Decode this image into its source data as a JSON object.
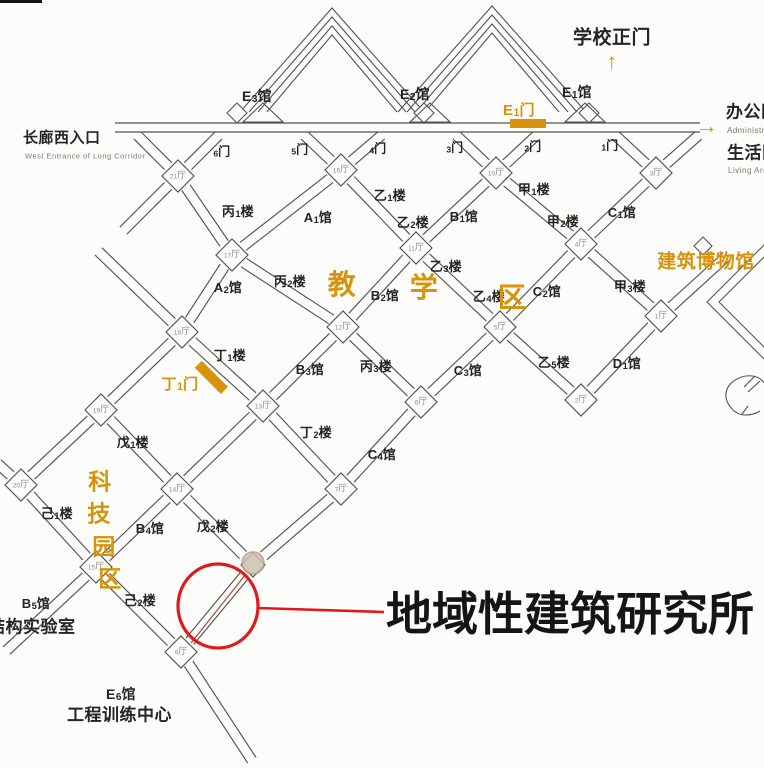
{
  "title": "campus-map-with-callout",
  "annotation": {
    "callout_text": "地域性建筑研究所",
    "callout_x": 386,
    "callout_y": 614,
    "callout_size": 46,
    "circle": {
      "cx": 218,
      "cy": 606,
      "rx": 40,
      "ry": 42
    },
    "line": {
      "x1": 257,
      "y1": 608,
      "x2": 384,
      "y2": 612
    }
  },
  "colors": {
    "accent": "#d7930c",
    "red": "#e2191b",
    "line": "#56524d",
    "hall_text": "#8f8c84",
    "text": "#242420",
    "sub": "#7d7a72",
    "marker_fill": "#cfc0b2",
    "marker_stroke": "#ab9a86",
    "highlight": "#a85440",
    "edge_artifact": "#141414"
  },
  "map": {
    "nodes": [
      {
        "id": "h21",
        "x": 178,
        "y": 176,
        "label": "21厅"
      },
      {
        "id": "h16",
        "x": 341,
        "y": 170,
        "label": "16厅"
      },
      {
        "id": "h10",
        "x": 496,
        "y": 173,
        "label": "10厅"
      },
      {
        "id": "h3",
        "x": 656,
        "y": 173,
        "label": "3厅"
      },
      {
        "id": "h17",
        "x": 232,
        "y": 255,
        "label": "17厅"
      },
      {
        "id": "h11",
        "x": 416,
        "y": 248,
        "label": "11厅"
      },
      {
        "id": "h4",
        "x": 581,
        "y": 244,
        "label": "4厅"
      },
      {
        "id": "h18",
        "x": 182,
        "y": 332,
        "label": "18厅"
      },
      {
        "id": "h12",
        "x": 343,
        "y": 327,
        "label": "12厅"
      },
      {
        "id": "h5",
        "x": 500,
        "y": 327,
        "label": "5厅"
      },
      {
        "id": "h1",
        "x": 661,
        "y": 316,
        "label": "1厅"
      },
      {
        "id": "h13",
        "x": 263,
        "y": 406,
        "label": "13厅"
      },
      {
        "id": "h6",
        "x": 421,
        "y": 402,
        "label": "6厅"
      },
      {
        "id": "h2",
        "x": 581,
        "y": 400,
        "label": "2厅"
      },
      {
        "id": "h19",
        "x": 101,
        "y": 410,
        "label": "19厅"
      },
      {
        "id": "h14",
        "x": 177,
        "y": 489,
        "label": "14厅"
      },
      {
        "id": "h7",
        "x": 341,
        "y": 489,
        "label": "7厅"
      },
      {
        "id": "h20",
        "x": 21,
        "y": 485,
        "label": "20厅"
      },
      {
        "id": "h15",
        "x": 96,
        "y": 567,
        "label": "15厅"
      },
      {
        "id": "h8",
        "x": 253,
        "y": 565,
        "label": ""
      },
      {
        "id": "h9",
        "x": 181,
        "y": 652,
        "label": "9厅"
      },
      {
        "id": "c0",
        "x": 136,
        "y": 134,
        "end": true
      },
      {
        "id": "c6",
        "x": 220,
        "y": 134,
        "end": true
      },
      {
        "id": "c5",
        "x": 303,
        "y": 134,
        "end": true
      },
      {
        "id": "c4",
        "x": 383,
        "y": 134,
        "end": true
      },
      {
        "id": "c3",
        "x": 455,
        "y": 134,
        "end": true
      },
      {
        "id": "c2",
        "x": 538,
        "y": 134,
        "end": true
      },
      {
        "id": "c1",
        "x": 614,
        "y": 134,
        "end": true
      },
      {
        "id": "c7",
        "x": 700,
        "y": 134,
        "end": true
      },
      {
        "id": "e21",
        "x": 122,
        "y": 232,
        "end": true
      },
      {
        "id": "e18",
        "x": 97,
        "y": 250,
        "end": true
      },
      {
        "id": "e20",
        "x": -4,
        "y": 462,
        "end": true
      },
      {
        "id": "eB5",
        "x": 5,
        "y": 652,
        "end": true
      },
      {
        "id": "eE6",
        "x": 253,
        "y": 762,
        "end": true
      },
      {
        "id": "eM",
        "x": 728,
        "y": 255,
        "end": true
      }
    ],
    "edges": [
      [
        "h21",
        "c0"
      ],
      [
        "h21",
        "c6"
      ],
      [
        "h16",
        "c5"
      ],
      [
        "h16",
        "c4"
      ],
      [
        "h10",
        "c3"
      ],
      [
        "h10",
        "c2"
      ],
      [
        "h3",
        "c1"
      ],
      [
        "h3",
        "c7"
      ],
      [
        "h21",
        "h17"
      ],
      [
        "h16",
        "h17"
      ],
      [
        "h16",
        "h11"
      ],
      [
        "h10",
        "h11"
      ],
      [
        "h10",
        "h4"
      ],
      [
        "h3",
        "h4"
      ],
      [
        "h17",
        "h18"
      ],
      [
        "h17",
        "h12"
      ],
      [
        "h11",
        "h12"
      ],
      [
        "h11",
        "h5"
      ],
      [
        "h4",
        "h5"
      ],
      [
        "h4",
        "h1"
      ],
      [
        "h1",
        "eM"
      ],
      [
        "h18",
        "h13"
      ],
      [
        "h12",
        "h13"
      ],
      [
        "h12",
        "h6"
      ],
      [
        "h5",
        "h6"
      ],
      [
        "h5",
        "h2"
      ],
      [
        "h1",
        "h2"
      ],
      [
        "h18",
        "h19"
      ],
      [
        "h19",
        "h14"
      ],
      [
        "h13",
        "h14"
      ],
      [
        "h13",
        "h7"
      ],
      [
        "h6",
        "h7"
      ],
      [
        "h19",
        "h20"
      ],
      [
        "h20",
        "e20"
      ],
      [
        "h20",
        "h15"
      ],
      [
        "h14",
        "h15"
      ],
      [
        "h14",
        "h8"
      ],
      [
        "h7",
        "h8"
      ],
      [
        "h15",
        "eB5"
      ],
      [
        "h15",
        "h9"
      ],
      [
        "h8",
        "h9"
      ],
      [
        "h9",
        "eE6"
      ],
      [
        "h21",
        "e21"
      ],
      [
        "h18",
        "e18"
      ]
    ],
    "labels": [
      {
        "t": "E3馆",
        "x": 257,
        "y": 97,
        "s": 14,
        "w": 700
      },
      {
        "t": "E2馆",
        "x": 415,
        "y": 95,
        "s": 14,
        "w": 700
      },
      {
        "t": "E1馆",
        "x": 577,
        "y": 93,
        "s": 14,
        "w": 700
      },
      {
        "t": "学校正门",
        "x": 612,
        "y": 38,
        "s": 19,
        "w": 700
      },
      {
        "t": "↑",
        "x": 612,
        "y": 62,
        "s": 22,
        "c": "accent",
        "w": 700
      },
      {
        "t": "E1门",
        "x": 519,
        "y": 111,
        "s": 15,
        "c": "accent",
        "w": 700
      },
      {
        "t": "→",
        "x": 707,
        "y": 126,
        "s": 22,
        "c": "accent",
        "w": 700
      },
      {
        "t": "办公区",
        "x": 726,
        "y": 112,
        "s": 17,
        "w": 700,
        "a": "left"
      },
      {
        "t": "Administration Area",
        "x": 727,
        "y": 131,
        "s": 8,
        "c": "sub",
        "a": "left"
      },
      {
        "t": "生活区",
        "x": 727,
        "y": 153,
        "s": 17,
        "w": 700,
        "a": "left"
      },
      {
        "t": "Living Area",
        "x": 728,
        "y": 171,
        "s": 8,
        "c": "sub",
        "a": "left"
      },
      {
        "t": "长廊西入口",
        "x": 23,
        "y": 138,
        "s": 15,
        "w": 700,
        "a": "left"
      },
      {
        "t": "West Entrance of Long Corridor",
        "x": 25,
        "y": 156,
        "s": 7.5,
        "c": "sub",
        "a": "left"
      },
      {
        "t": "6门",
        "x": 222,
        "y": 152,
        "s": 12,
        "w": 600
      },
      {
        "t": "5门",
        "x": 300,
        "y": 150,
        "s": 12,
        "w": 600
      },
      {
        "t": "4门",
        "x": 378,
        "y": 149,
        "s": 12,
        "w": 600
      },
      {
        "t": "3门",
        "x": 455,
        "y": 148,
        "s": 12,
        "w": 600
      },
      {
        "t": "2门",
        "x": 533,
        "y": 147,
        "s": 12,
        "w": 600
      },
      {
        "t": "1门",
        "x": 610,
        "y": 146,
        "s": 12,
        "w": 600
      },
      {
        "t": "丙1楼",
        "x": 238,
        "y": 212,
        "s": 13,
        "w": 700
      },
      {
        "t": "A1馆",
        "x": 318,
        "y": 218,
        "s": 13,
        "w": 700
      },
      {
        "t": "乙1楼",
        "x": 390,
        "y": 196,
        "s": 13,
        "w": 700
      },
      {
        "t": "乙2楼",
        "x": 413,
        "y": 223,
        "s": 13,
        "w": 700
      },
      {
        "t": "B1馆",
        "x": 464,
        "y": 217,
        "s": 13,
        "w": 700
      },
      {
        "t": "甲1楼",
        "x": 534,
        "y": 190,
        "s": 13,
        "w": 700
      },
      {
        "t": "甲2楼",
        "x": 563,
        "y": 222,
        "s": 13,
        "w": 700
      },
      {
        "t": "C1馆",
        "x": 622,
        "y": 213,
        "s": 13,
        "w": 700
      },
      {
        "t": "A2馆",
        "x": 228,
        "y": 288,
        "s": 13,
        "w": 700
      },
      {
        "t": "丙2楼",
        "x": 290,
        "y": 282,
        "s": 13,
        "w": 700
      },
      {
        "t": "教",
        "x": 342,
        "y": 285,
        "s": 28,
        "c": "accent",
        "w": 700
      },
      {
        "t": "B2馆",
        "x": 385,
        "y": 296,
        "s": 13,
        "w": 700
      },
      {
        "t": "学",
        "x": 424,
        "y": 288,
        "s": 28,
        "c": "accent",
        "w": 700
      },
      {
        "t": "乙3楼",
        "x": 446,
        "y": 267,
        "s": 13,
        "w": 700
      },
      {
        "t": "乙4楼",
        "x": 489,
        "y": 297,
        "s": 13,
        "w": 700
      },
      {
        "t": "区",
        "x": 512,
        "y": 298,
        "s": 28,
        "c": "accent",
        "w": 700
      },
      {
        "t": "C2馆",
        "x": 547,
        "y": 292,
        "s": 13,
        "w": 700
      },
      {
        "t": "甲3楼",
        "x": 630,
        "y": 287,
        "s": 13,
        "w": 700
      },
      {
        "t": "建筑博物馆",
        "x": 706,
        "y": 262,
        "s": 19,
        "c": "accent",
        "w": 700
      },
      {
        "t": "丁1楼",
        "x": 230,
        "y": 356,
        "s": 13,
        "w": 700
      },
      {
        "t": "B3馆",
        "x": 310,
        "y": 370,
        "s": 13,
        "w": 700
      },
      {
        "t": "丙3楼",
        "x": 376,
        "y": 367,
        "s": 13,
        "w": 700
      },
      {
        "t": "C3馆",
        "x": 468,
        "y": 371,
        "s": 13,
        "w": 700
      },
      {
        "t": "乙5楼",
        "x": 554,
        "y": 363,
        "s": 13,
        "w": 700
      },
      {
        "t": "D1馆",
        "x": 627,
        "y": 364,
        "s": 13,
        "w": 700
      },
      {
        "t": "丁1门",
        "x": 180,
        "y": 385,
        "s": 15,
        "c": "accent",
        "w": 700
      },
      {
        "t": "戊1楼",
        "x": 133,
        "y": 443,
        "s": 13,
        "w": 700
      },
      {
        "t": "丁2楼",
        "x": 316,
        "y": 433,
        "s": 13,
        "w": 700
      },
      {
        "t": "C4馆",
        "x": 382,
        "y": 455,
        "s": 13,
        "w": 700
      },
      {
        "t": "科",
        "x": 100,
        "y": 482,
        "s": 23,
        "c": "accent",
        "w": 700
      },
      {
        "t": "技",
        "x": 99,
        "y": 514,
        "s": 23,
        "c": "accent",
        "w": 700
      },
      {
        "t": "园",
        "x": 104,
        "y": 547,
        "s": 23,
        "c": "accent",
        "w": 700
      },
      {
        "t": "区",
        "x": 110,
        "y": 579,
        "s": 23,
        "c": "accent",
        "w": 700
      },
      {
        "t": "己1楼",
        "x": 57,
        "y": 514,
        "s": 13,
        "w": 700
      },
      {
        "t": "B4馆",
        "x": 150,
        "y": 529,
        "s": 13,
        "w": 700
      },
      {
        "t": "戊2楼",
        "x": 213,
        "y": 527,
        "s": 13,
        "w": 700
      },
      {
        "t": "B5馆",
        "x": 36,
        "y": 604,
        "s": 13,
        "w": 700
      },
      {
        "t": "己2楼",
        "x": 140,
        "y": 601,
        "s": 13,
        "w": 700
      },
      {
        "t": "结构实验室",
        "x": -12,
        "y": 627,
        "s": 17,
        "w": 700,
        "a": "left"
      },
      {
        "t": "E6馆",
        "x": 121,
        "y": 695,
        "s": 14,
        "w": 700
      },
      {
        "t": "工程训练中心",
        "x": 67,
        "y": 715,
        "s": 17,
        "w": 700,
        "a": "left"
      }
    ]
  }
}
